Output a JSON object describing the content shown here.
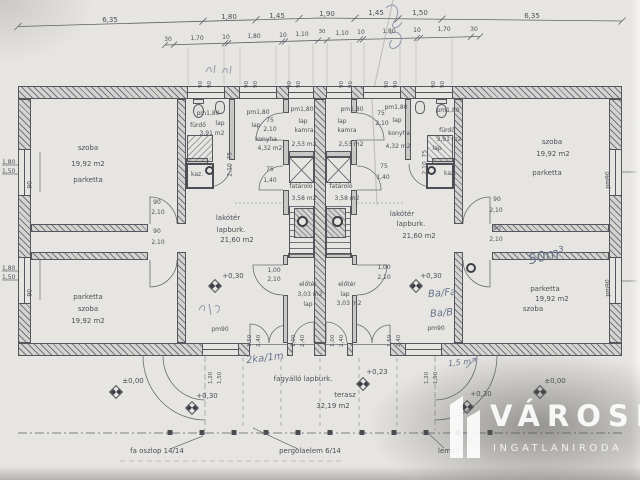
{
  "dimensions": {
    "row1": [
      "6,35",
      "1,80",
      "1,45",
      "1,90",
      "1,45",
      "1,50",
      "6,35"
    ],
    "row2": [
      "30",
      "1,70",
      "10",
      "1,80",
      "10",
      "1,10",
      "30",
      "1,10",
      "10",
      "1,80",
      "10",
      "1,70",
      "30"
    ],
    "jambs": [
      "90",
      "90",
      "90",
      "90",
      "90",
      "90",
      "90",
      "90",
      "90",
      "90",
      "90",
      "90"
    ],
    "left_windows": [
      "1,80",
      "1,50",
      "1,80",
      "1,50"
    ],
    "left_jambs": [
      "90",
      "90"
    ],
    "right_parapets": [
      "pm90",
      "pm90"
    ],
    "bottom_window_left": [
      "pm90",
      "1,20",
      "1,50"
    ],
    "bottom_window_right": [
      "pm90",
      "1,20",
      "1,50"
    ]
  },
  "rooms": {
    "szoba_tl": {
      "name": "szoba",
      "area": "19,92 m2",
      "floor": "parketta"
    },
    "szoba_tr": {
      "name": "szoba",
      "area": "19,92 m2",
      "floor": "parketta"
    },
    "szoba_bl": {
      "name": "szoba",
      "area": "19,92 m2",
      "floor": "parketta"
    },
    "szoba_br": {
      "name": "szoba",
      "area": "19,92 m2",
      "floor": "parketta"
    },
    "furdo_l": {
      "parapet": "pm1,80",
      "name": "fürdő",
      "floor": "lap",
      "area": "3,91 m2"
    },
    "furdo_r": {
      "parapet": "pm1,80",
      "name": "fürdő",
      "floor": "lap",
      "area": "3,91 m2"
    },
    "konyha_l": {
      "parapet": "pm1,80",
      "floor": "lap",
      "name": "konyha",
      "area": "4,32 m2"
    },
    "konyha_r": {
      "parapet": "pm1,80",
      "floor": "lap",
      "name": "konyha",
      "area": "4,32 m2"
    },
    "kamra_l": {
      "parapet": "pm1,80",
      "floor": "lap",
      "name": "kamra",
      "area": "2,53 m2"
    },
    "kamra_r": {
      "parapet": "pm1,80",
      "floor": "lap",
      "name": "kamra",
      "area": "2,53 m2"
    },
    "lakoter_l": {
      "name": "lakótér",
      "floor": "lapburk.",
      "area": "21,60 m2",
      "level": "+0,30"
    },
    "lakoter_r": {
      "name": "lakótér",
      "floor": "lapburk.",
      "area": "21,60 m2",
      "level": "+0,30"
    },
    "eloter_l": {
      "name": "előtér",
      "area": "3,03 m2",
      "floor": "lap"
    },
    "eloter_r": {
      "name": "előtér",
      "floor": "lap",
      "area": "3,03 m2"
    },
    "fatarolo_l": {
      "name": "fatároló",
      "area": "3,58 m2"
    },
    "fatarolo_r": {
      "name": "fatároló",
      "area": "3,58 m2"
    },
    "terasz": {
      "name": "terasz",
      "area": "32,19 m2",
      "floor": "fagyálló lapburk."
    }
  },
  "doors": {
    "szoba_left": [
      "90",
      "2,10",
      "90",
      "2,10"
    ],
    "szoba_right": [
      "90",
      "2,10",
      "90",
      "2,10"
    ],
    "konyha_left": [
      "75",
      "2,10"
    ],
    "konyha_right": [
      "75",
      "2,10"
    ],
    "furdo_left": [
      "75",
      "2,10"
    ],
    "furdo_right": [
      "75",
      "2,10"
    ],
    "fatarolo_left": [
      "75",
      "1,40"
    ],
    "fatarolo_right": [
      "75",
      "1,40"
    ],
    "eloter_left": [
      "1,00",
      "2,10"
    ],
    "eloter_right": [
      "1,00",
      "2,10"
    ],
    "terrace_left": [
      "1,50",
      "2,40"
    ],
    "terrace_right": [
      "1,50",
      "2,40"
    ],
    "entry_left": [
      "1,00",
      "2,40"
    ],
    "entry_right": [
      "1,00",
      "2,40"
    ]
  },
  "levels": {
    "ground": "±0,00",
    "terrace": "+0,30",
    "living": "+0,30",
    "step": "+0,23"
  },
  "equipment": {
    "boiler": "kaz."
  },
  "notes": {
    "post": "fa oszlop 14/14",
    "pergola": "pergolaelem 6/14",
    "sheet": "lemez"
  },
  "handwriting": {
    "terrace_note": "2ka/1m",
    "volume_note": "50m³",
    "code_a": "Ba/Fa",
    "code_b": "Ba/B",
    "length_note": "1,5 m"
  },
  "watermark": {
    "title": "VÁROSI",
    "subtitle": "INGATLANIRODA"
  },
  "colors": {
    "paper": "#e7e5e1",
    "line": "#54565e",
    "watermark_text": "#ffffff",
    "shadow": "#5a5856",
    "handwriting": "#6b7690"
  }
}
